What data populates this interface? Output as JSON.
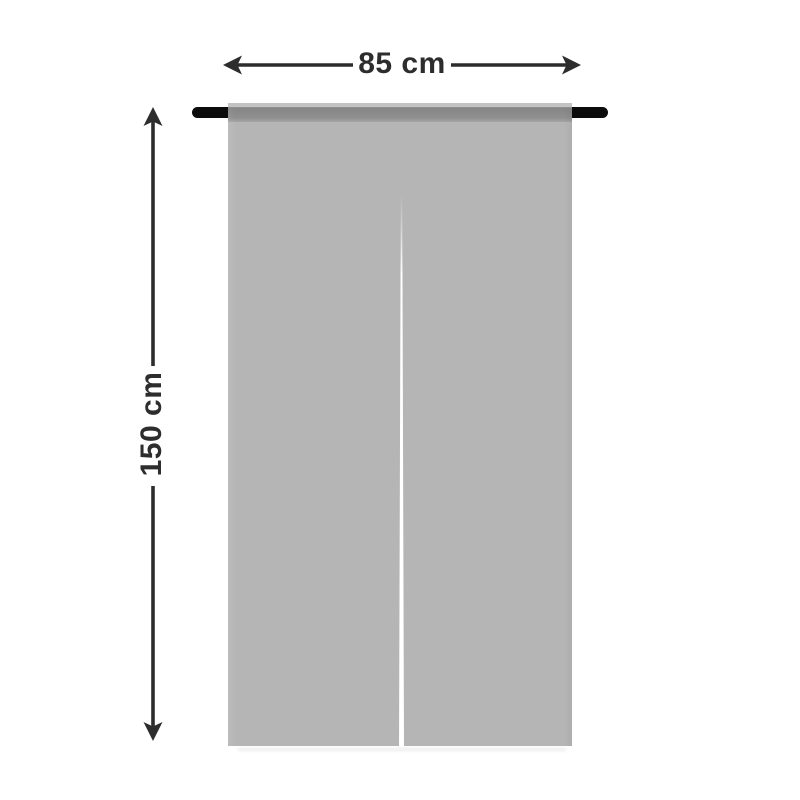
{
  "diagram": {
    "subject": "noren-door-curtain-size-diagram",
    "width_label": "85 cm",
    "height_label": "150 cm"
  },
  "icons": {
    "width_arrow": "double-headed-horizontal-arrow-icon",
    "height_arrow": "double-headed-vertical-arrow-icon"
  },
  "colors": {
    "background": "#ffffff",
    "curtain_body": "#b5b5b5",
    "curtain_top_hem": "#c3c3c3",
    "rod_pocket_band": "#8a8a8a",
    "rod": "#0c0c0c",
    "slit": "#ffffff",
    "dimension_lines_and_text": "#2d2d2d"
  }
}
